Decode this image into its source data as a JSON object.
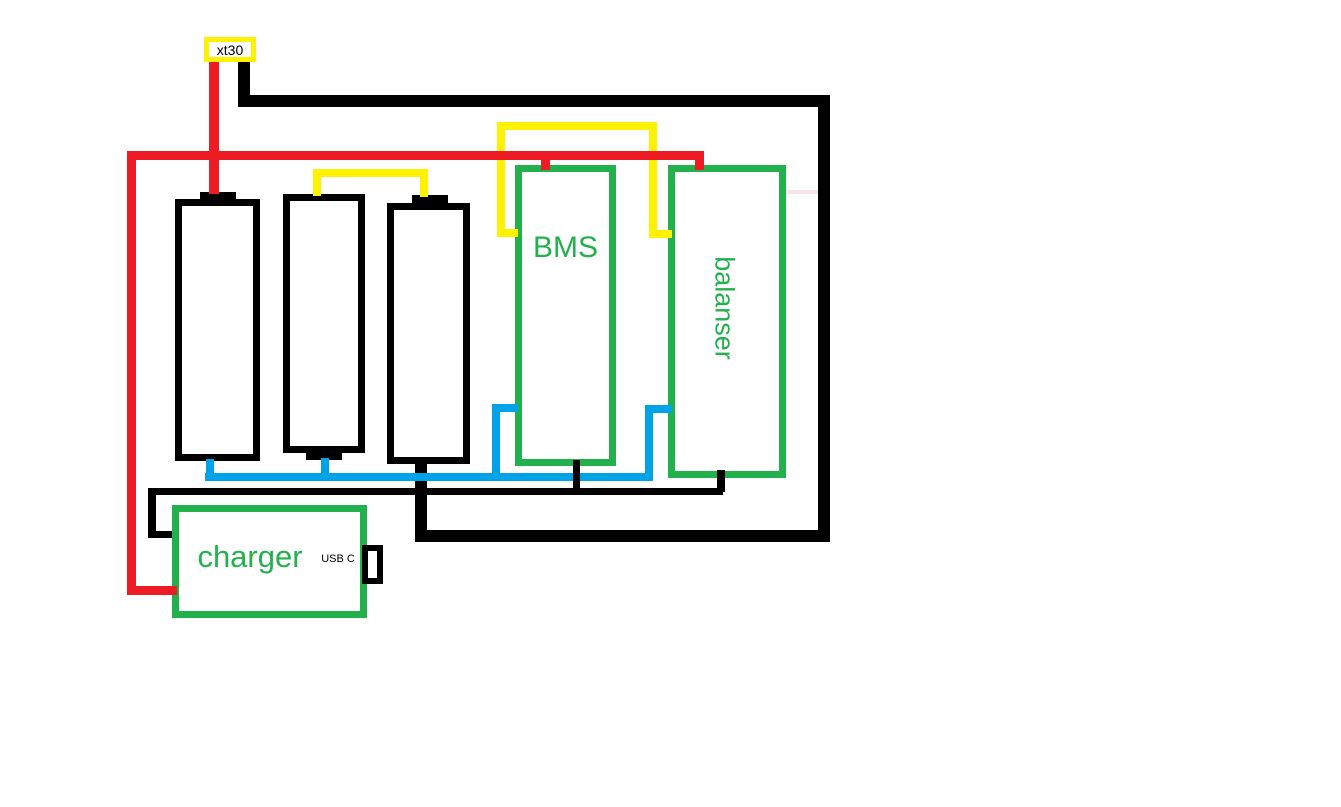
{
  "colors": {
    "red": "#ED1C24",
    "yellow": "#FFF200",
    "green": "#22B14C",
    "blue": "#00A2E8",
    "black": "#000000",
    "white": "#FFFFFF",
    "faint_pink": "#FBE3E5"
  },
  "connector": {
    "label": "xt30"
  },
  "components": {
    "bms": {
      "label": "BMS"
    },
    "balancer": {
      "label": "balanser"
    },
    "charger": {
      "label": "charger",
      "port_label": "USB C"
    },
    "battery_count": 3
  }
}
